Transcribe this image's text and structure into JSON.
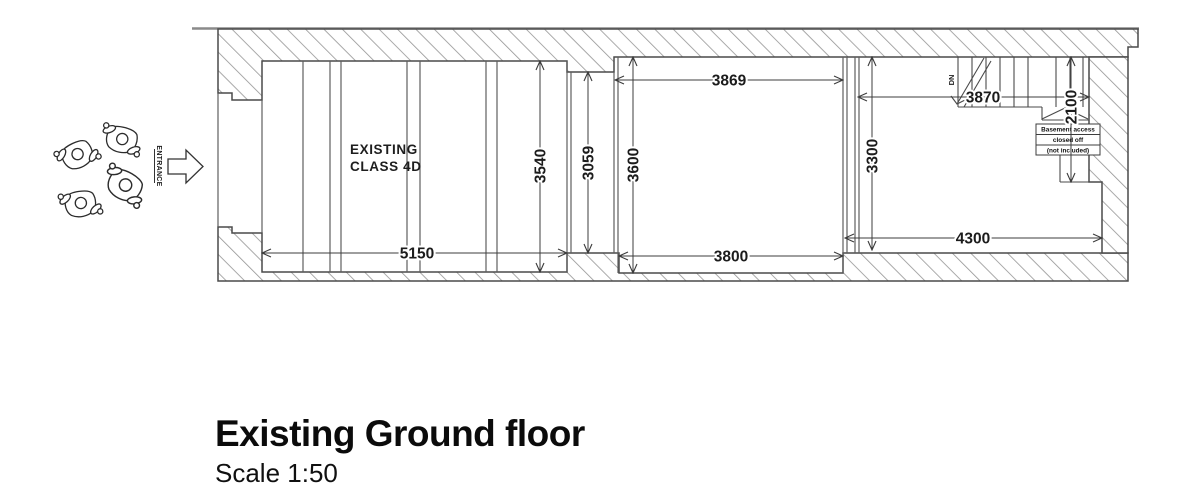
{
  "plan": {
    "room_label_line1": "EXISTING",
    "room_label_line2": "CLASS 4D",
    "entrance_label": "ENTRANCE",
    "stairs_direction_label": "DN",
    "basement_note_line1": "Basement access",
    "basement_note_line2": "closed off",
    "basement_note_line3": "(not included)",
    "dims": {
      "left_room_width": "5150",
      "left_room_depth": "3540",
      "passage_depth": "3059",
      "middle_room_top_width": "3869",
      "middle_room_bottom_width": "3800",
      "middle_room_depth": "3600",
      "right_room_depth": "3300",
      "right_room_top_width": "3870",
      "right_room_bottom_width": "4300",
      "stair_zone_depth": "2100"
    }
  },
  "title_block": {
    "title": "Existing Ground floor",
    "scale": "Scale 1:50"
  }
}
